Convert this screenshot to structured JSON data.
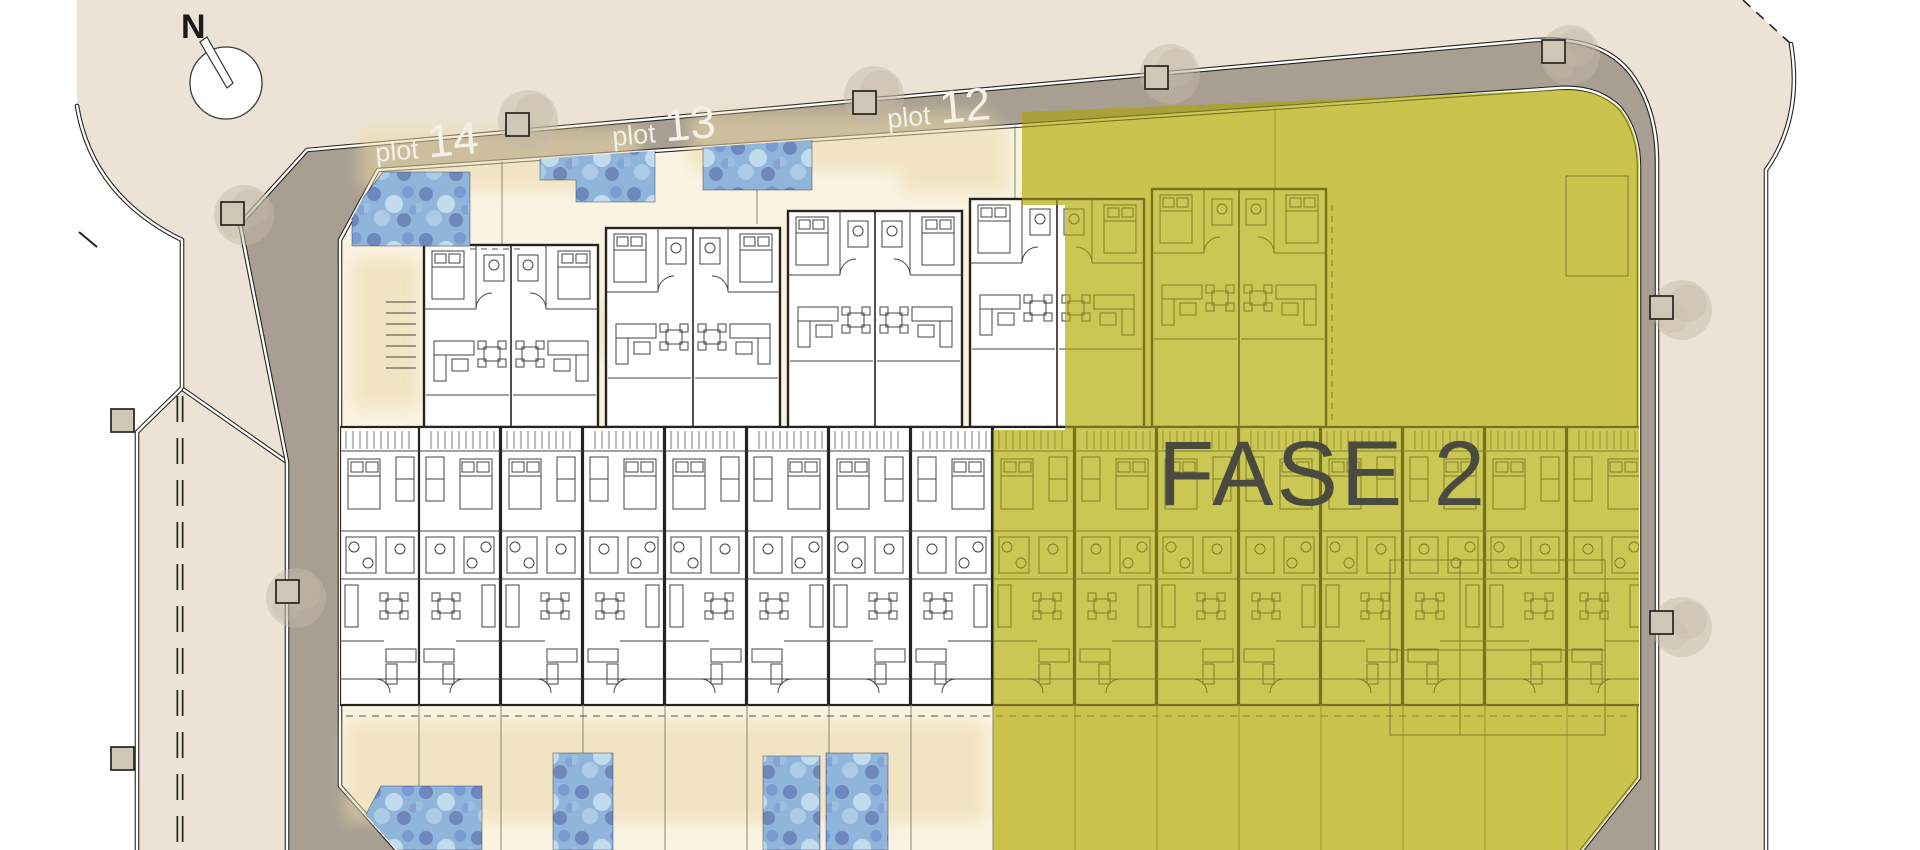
{
  "site_plan": {
    "compass": {
      "label": "N"
    },
    "phase": {
      "label": "FASE 2"
    },
    "plots": [
      {
        "prefix": "plot",
        "number": "14"
      },
      {
        "prefix": "plot",
        "number": "13"
      },
      {
        "prefix": "plot",
        "number": "12"
      }
    ],
    "colors": {
      "background": "#ECE3D6",
      "outside_road": "#FFFFFF",
      "perimeter_road": "#A89F92",
      "development_ground": "#FAF3E2",
      "sand_wash": "#ECD8A8",
      "building_fill": "#FFFFFF",
      "wall_line": "#26241F",
      "phase_overlay": "#D6D25A",
      "phase_label_color": "#4B4A40",
      "plot_label_color": "#F4F0E6",
      "pool_water": "#8FB6DA",
      "pool_shadow": "#5E73B4",
      "pool_light": "#C8DFF0",
      "tree_foliage": "#C6B9A6",
      "road_post": "#CFC6B6"
    }
  }
}
